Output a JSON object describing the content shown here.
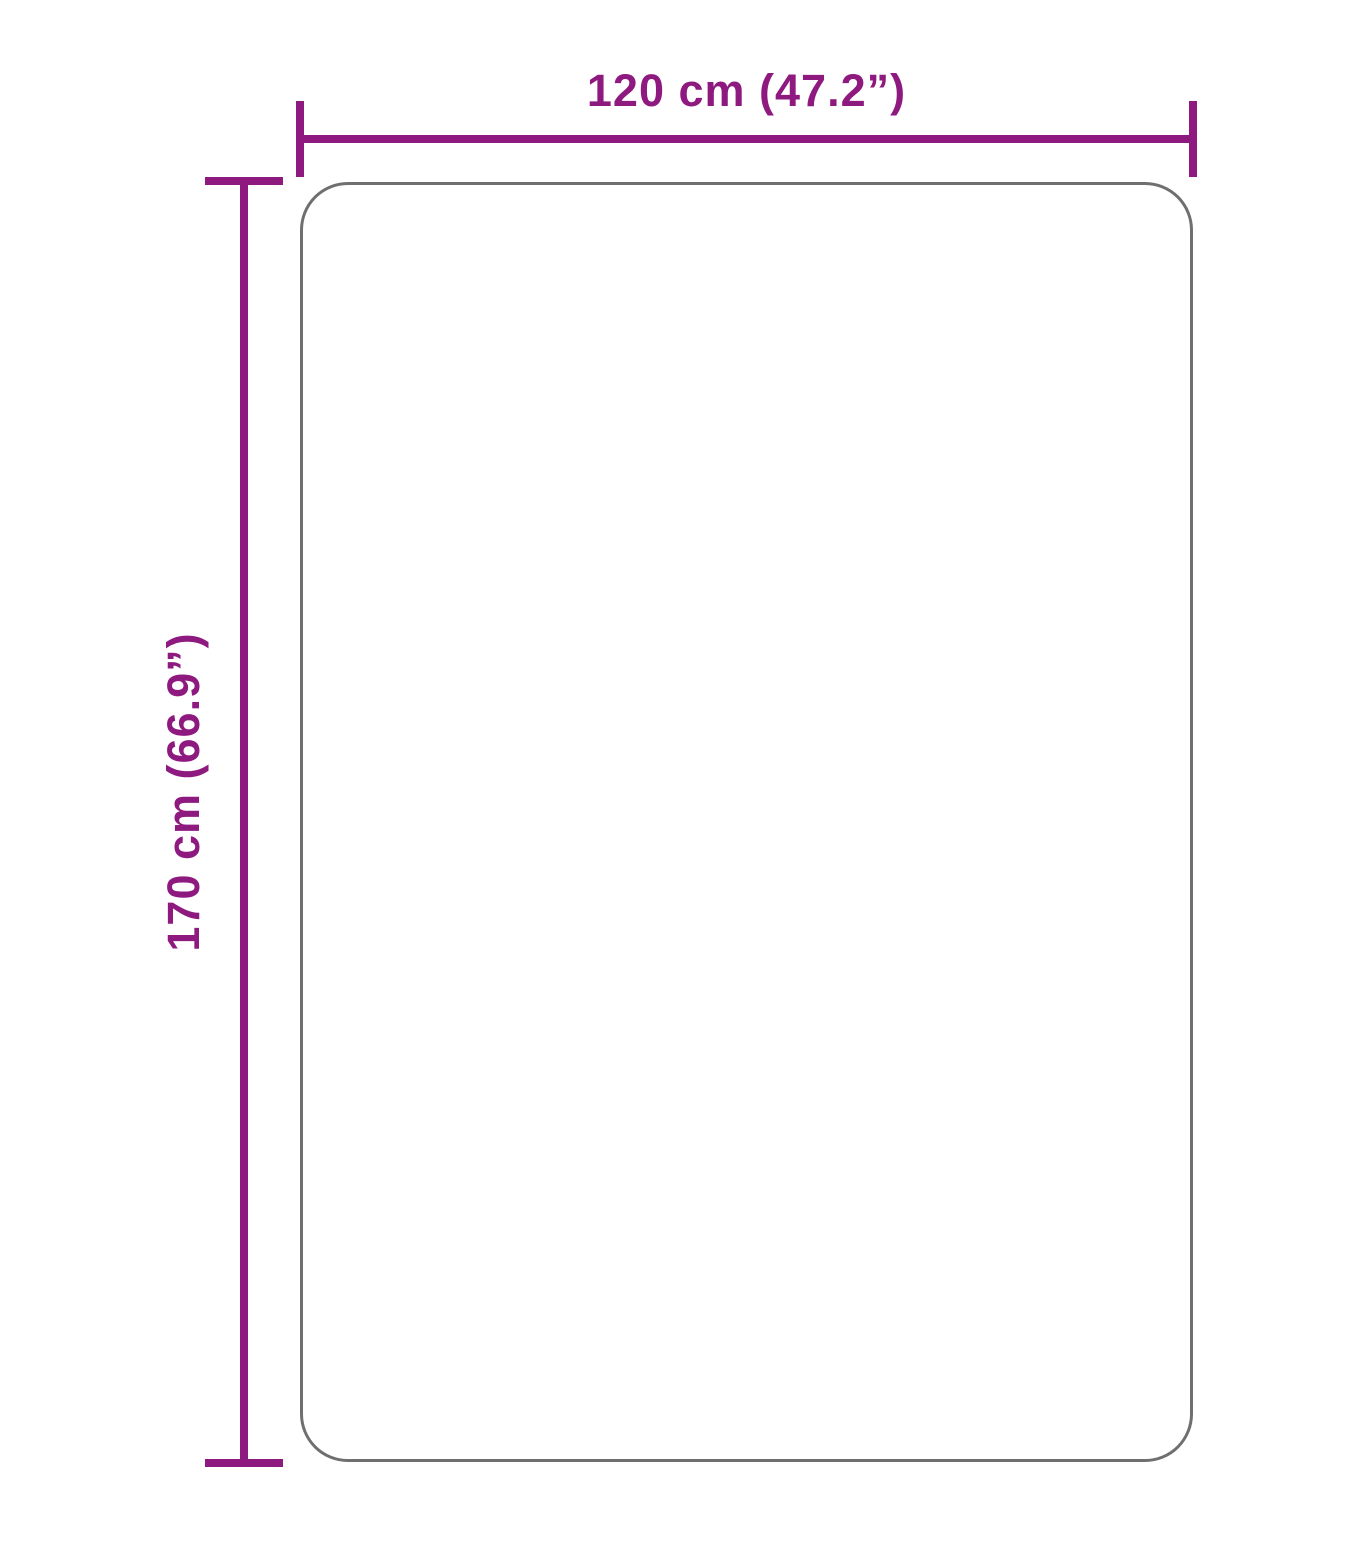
{
  "diagram": {
    "type": "product-dimension-diagram",
    "width_label": "120 cm (47.2”)",
    "height_label": "170 cm (66.9”)"
  },
  "colors": {
    "dimension_accent": "#8e1a80",
    "outline_gray": "#6f6f6f",
    "background": "#ffffff"
  }
}
